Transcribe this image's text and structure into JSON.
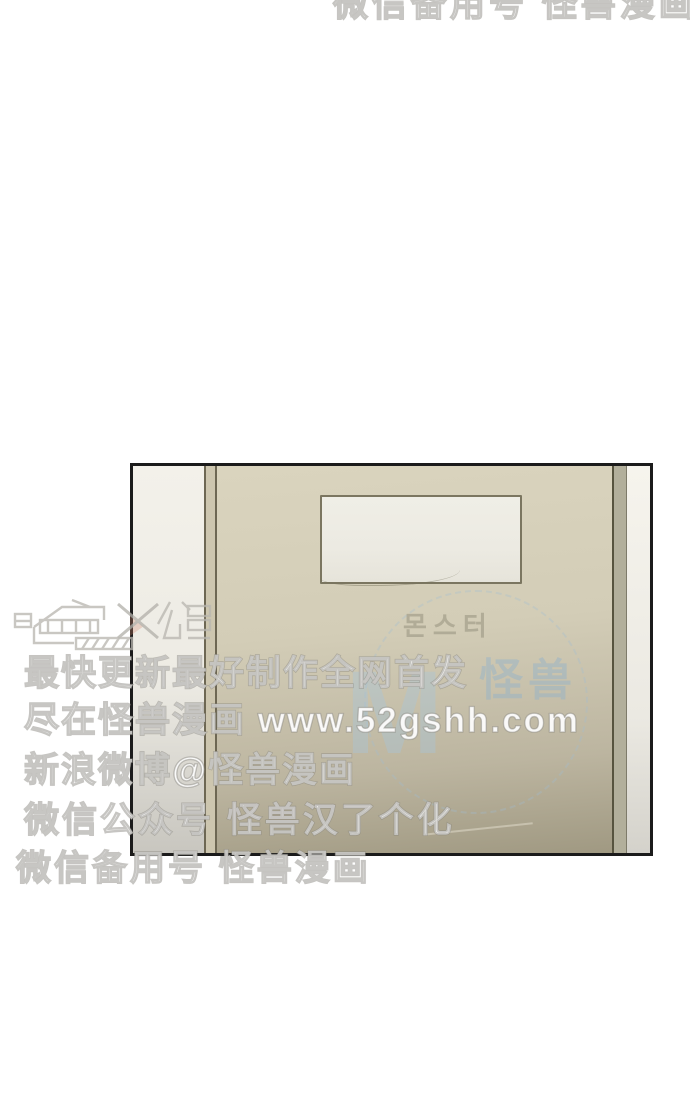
{
  "watermark": {
    "top_line": "微信备用号 怪兽漫画",
    "logo": "怪兽汉化组",
    "lines": [
      "最快更新最好制作全网首发",
      "尽在怪兽漫画 www.52gshh.com",
      "新浪微博@怪兽漫画",
      "微信公众号 怪兽汉了个化",
      "微信备用号 怪兽漫画"
    ]
  },
  "panel": {
    "watermark": {
      "korean_title": "몬스터",
      "monogram": "M",
      "brand": "怪兽"
    },
    "colors": {
      "panel_border": "#1b1b1b",
      "door_top": "#d8d2bc",
      "door_bottom": "#a09982",
      "frame_line": "#6d6753",
      "wall_light": "#f3f1ea",
      "sign_fill": "#eeede5",
      "sign_border": "#7b7660",
      "watermark_blue": "#a5c3dc",
      "logo_accent_red": "#d4a090"
    }
  }
}
